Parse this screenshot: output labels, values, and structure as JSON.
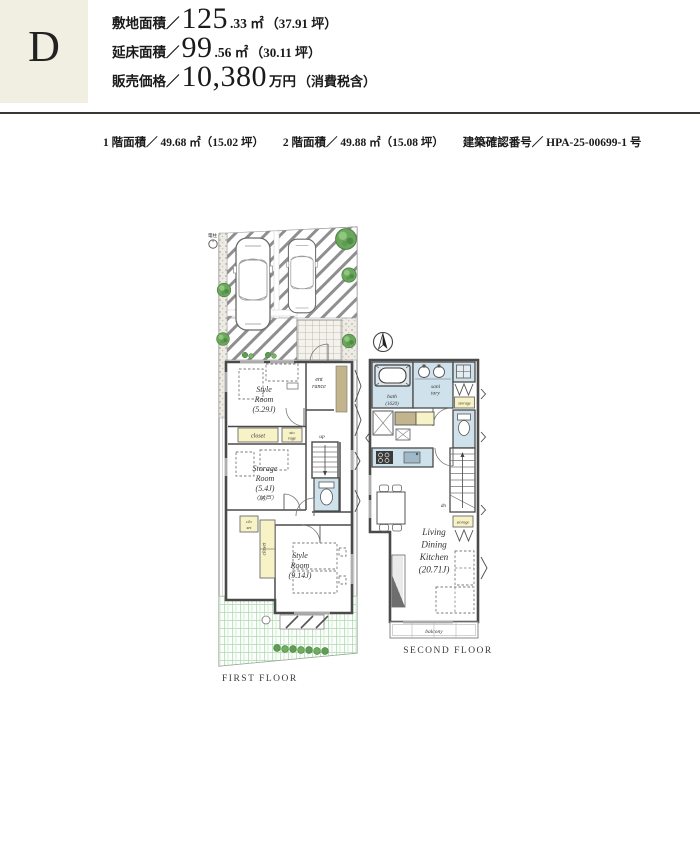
{
  "header": {
    "plan_letter": "D",
    "specs": [
      {
        "label": "敷地面積／",
        "big": "125",
        "small": ".33 ㎡",
        "paren": "（37.91 坪）"
      },
      {
        "label": "延床面積／",
        "big": "99",
        "small": ".56 ㎡",
        "paren": "（30.11 坪）"
      },
      {
        "label": "販売価格／",
        "big": "10,380",
        "small": "万円",
        "paren": "（消費税含）"
      }
    ]
  },
  "subinfo": {
    "floor1": "1 階面積／ 49.68 ㎡（15.02 坪）",
    "floor2": "2 階面積／ 49.88 ㎡（15.08 坪）",
    "permit": "建築確認番号／ HPA-25-00699-1 号"
  },
  "first_floor": {
    "caption": "FIRST FLOOR",
    "pole": "電柱",
    "style_room_1": {
      "l1": "Style",
      "l2": "Room",
      "l3": "(5.29J)"
    },
    "entrance": {
      "l1": "ent",
      "l2": "rance"
    },
    "closet_main": "closet",
    "storage_small": {
      "l1": "sto",
      "l2": "rage"
    },
    "storage_room": {
      "l1": "Storage",
      "l2": "Room",
      "l3": "(5.4J)",
      "l4": "〈納戸〉"
    },
    "up": "up",
    "closet_small": {
      "l1": "clo",
      "l2": "set"
    },
    "closet_tall": "closet",
    "style_room_2": {
      "l1": "Style",
      "l2": "Room",
      "l3": "(9.14J)"
    }
  },
  "second_floor": {
    "caption": "SECOND FLOOR",
    "bath": {
      "l1": "bath",
      "l2": "(1620)"
    },
    "sanitary": {
      "l1": "sani",
      "l2": "tary"
    },
    "storage_top": "storage",
    "storage_mid": "storage",
    "down": "dn",
    "ldk": {
      "l1": "Living",
      "l2": "Dining",
      "l3": "Kitchen",
      "l4": "(20.71J)"
    },
    "balcony": "balcony"
  },
  "colors": {
    "accent_beige": "#f1eee2",
    "wet_area": "#cfe2ec",
    "closet_fill": "#f8f3c6",
    "wood": "#c2b48c",
    "tree_green": "#5f9e52",
    "lawn_green": "#9ccf9f",
    "wall_gray": "#4a4a4a"
  }
}
